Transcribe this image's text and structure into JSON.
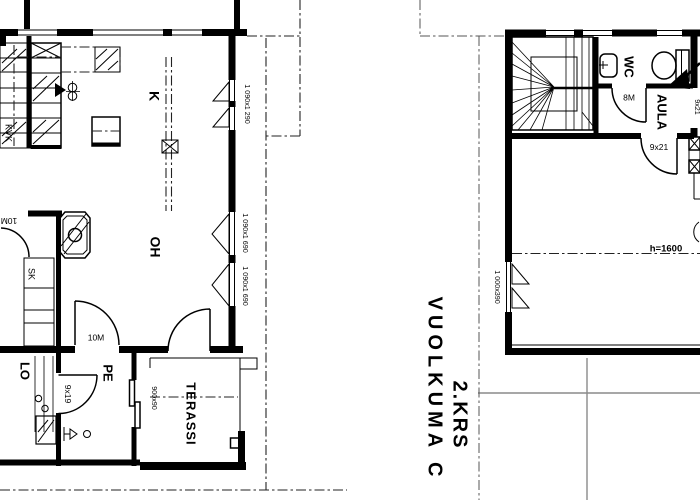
{
  "title": {
    "floor": "2.KRS",
    "name": "VUOLKUMA C"
  },
  "floor1": {
    "room_kvk": "KVK",
    "room_kitchen": "K",
    "room_living": "OH",
    "room_closet": "SK",
    "room_lo": "LO",
    "room_pe": "PE",
    "room_terrace": "TERASSI",
    "door_closet": "10M",
    "door_hall": "10M",
    "door_pe": "9x19",
    "win_terrace": "900x90",
    "win1": "1 090x1 290",
    "win2": "1 090x1 690",
    "win3": "1 090x1 690"
  },
  "floor2": {
    "room_wc": "WC",
    "room_hall": "AULA",
    "door_wc": "8M",
    "door_room": "9x21",
    "door_entry": "9x21",
    "win1": "1 000x390",
    "height_note": "h=1600"
  },
  "colors": {
    "ink": "#000000",
    "roof_line": "#8a8a8a"
  }
}
